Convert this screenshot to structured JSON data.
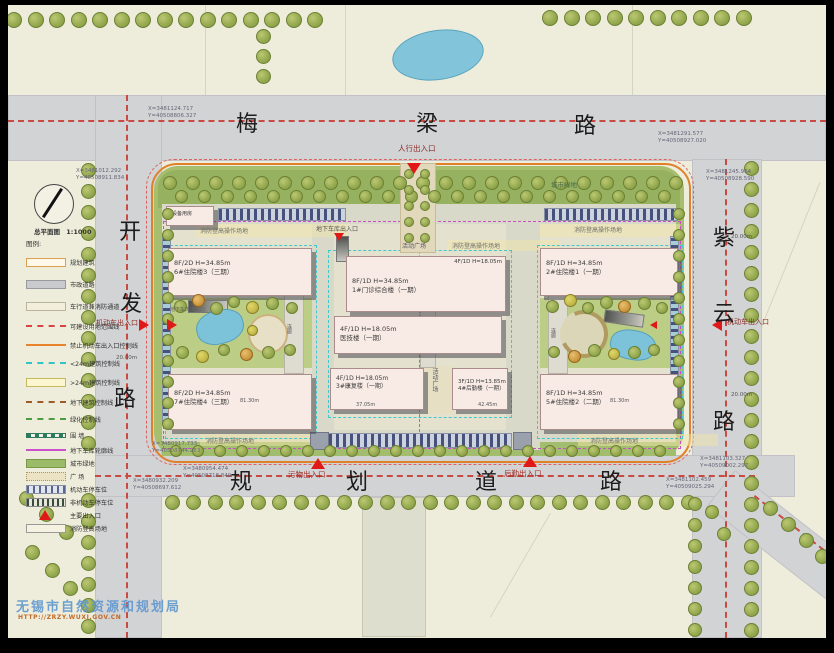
{
  "title_block": {
    "name": "总平面图",
    "scale": "1:1000"
  },
  "legend": {
    "title": "图例:",
    "items": [
      "规划建筑",
      "市政道路",
      "车行道兼消防通道",
      "可建设用地范围线",
      "禁止机动车出入口控制线",
      "<24m建筑控制线",
      ">24m建筑控制线",
      "地下建筑控制线",
      "绿化控制线",
      "围  墙",
      "地下车库轮廓线",
      "城市绿地",
      "广  场",
      "机动车停车位",
      "非机动车停车位",
      "主要出入口",
      "消防登高场地"
    ]
  },
  "roads": {
    "north": {
      "chars": [
        "梅",
        "梁",
        "路"
      ]
    },
    "west": {
      "chars": [
        "开",
        "发",
        "路"
      ]
    },
    "east": {
      "chars": [
        "紫",
        "云",
        "路"
      ]
    },
    "south": {
      "chars": [
        "规",
        "划",
        "道",
        "路"
      ]
    }
  },
  "buildings": {
    "equip": {
      "name": "设备用房"
    },
    "b6": {
      "spec": "8F/2D H=34.85m",
      "name": "6#住院楼3（三期）"
    },
    "b7": {
      "spec": "8F/2D H=34.85m",
      "name": "7#住院楼4（三期）",
      "dim": "81.30m"
    },
    "b1": {
      "spec": "8F/1D H=34.85m",
      "name": "1#门诊综合楼（一期）",
      "wing_spec": "4F/1D H=18.05m"
    },
    "med": {
      "spec": "4F/1D H=18.05m",
      "name": "医技楼（一期）"
    },
    "b3": {
      "spec": "4F/1D H=18.05m",
      "name": "3#康复楼（一期）",
      "dim": "37.05m"
    },
    "b4": {
      "spec": "3F/1D H=13.85m",
      "name": "4#后勤楼（一期）",
      "dim": "42.45m"
    },
    "b2": {
      "spec": "8F/1D H=34.85m",
      "name": "2#住院楼1（一期）"
    },
    "b5": {
      "spec": "8F/1D H=34.85m",
      "name": "5#住院楼2（二期）",
      "dim": "81.30m"
    }
  },
  "entrances": {
    "pedestrian": "人行出入口",
    "vehicle": "机动车出入口",
    "waste": "污物出入口",
    "logistics": "后勤出入口",
    "garage": "地下车库出入口"
  },
  "labels": {
    "fire_ops": "消防登高操作场地",
    "plaza": "活动广场",
    "city_green": "城市绿地",
    "corridor": "连廊",
    "road_width": "20.00m"
  },
  "coords": [
    {
      "x": "X=3481124.717",
      "y": "Y=40508806.327"
    },
    {
      "x": "X=3481291.577",
      "y": "Y=40508927.020"
    },
    {
      "x": "X=3481245.964",
      "y": "Y=40508928.590"
    },
    {
      "x": "X=3481012.292",
      "y": "Y=40508911.834"
    },
    {
      "x": "X=3480917.733",
      "y": "Y=40508744.283"
    },
    {
      "x": "X=3480954.474",
      "y": "Y=40508718.840"
    },
    {
      "x": "X=3480932.209",
      "y": "Y=40508697.612"
    },
    {
      "x": "X=3481103.327",
      "y": "Y=40509002.297"
    },
    {
      "x": "X=3481102.459",
      "y": "Y=40509025.294"
    }
  ],
  "watermark": {
    "agency": "无锡市自然资源和规划局",
    "url": "HTTP://ZRZY.WUXI.GOV.CN"
  },
  "colors": {
    "boundary": "#e0812a",
    "red_line": "#d04038",
    "garage_outline": "#c84fc8",
    "control_line": "#38c8cc",
    "entrance_marker": "#e01818"
  }
}
